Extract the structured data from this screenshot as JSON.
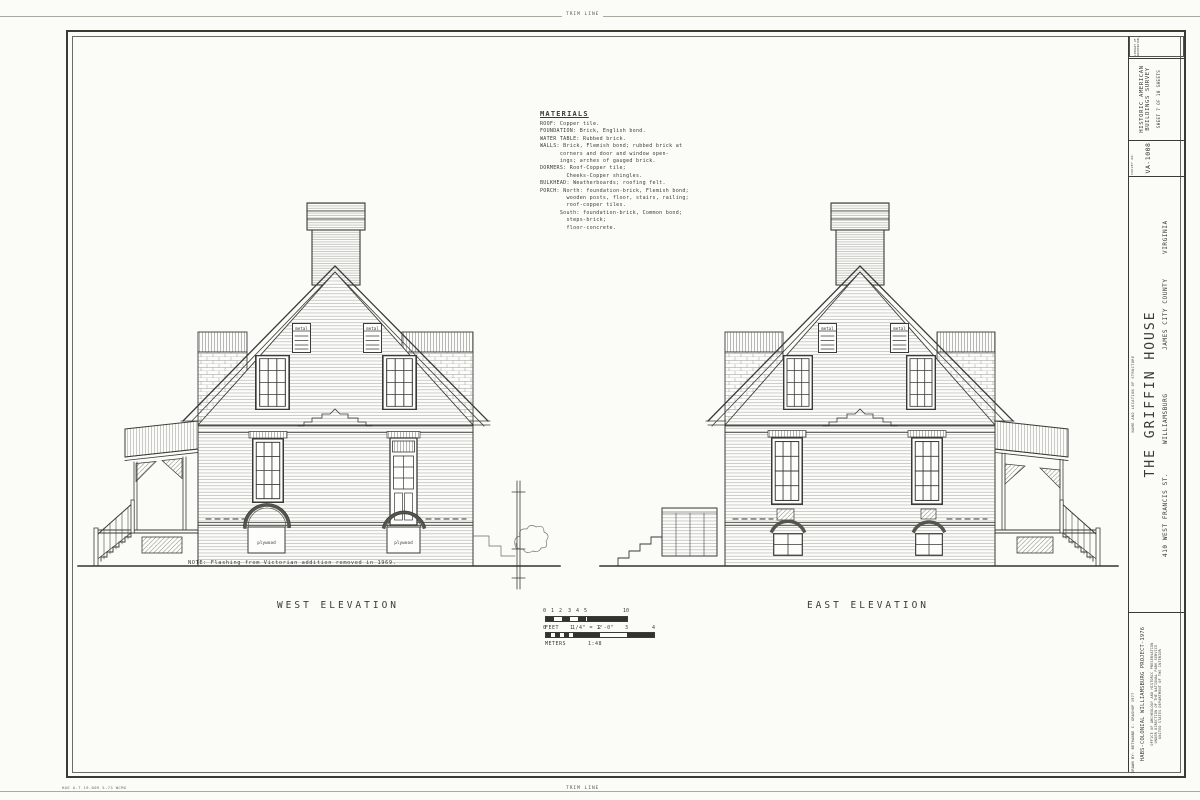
{
  "sheet": {
    "trim_label_top": "TRIM LINE",
    "trim_label_bottom": "TRIM LINE",
    "print_code": "HAE O-T 19-009 5-73 WCMG"
  },
  "materials": {
    "title": "MATERIALS",
    "lines": [
      "ROOF: Copper tile.",
      "FOUNDATION: Brick, English bond.",
      "WATER TABLE: Rubbed brick.",
      "WALLS: Brick, Flemish bond; rubbed brick at",
      "      corners and door and window open-",
      "      ings; arches of gauged brick.",
      "DORMERS: Roof-Copper tile;",
      "        Cheeks-Copper shingles.",
      "BULKHEAD: Weatherboards; roofing felt.",
      "PORCH: North: foundation-brick, Flemish bond;",
      "        wooden posts, floor, stairs, railing;",
      "        roof-copper tiles.",
      "      South: foundation-brick, Common bond;",
      "        steps-brick;",
      "        floor-concrete."
    ]
  },
  "west": {
    "label": "WEST ELEVATION",
    "note": "NOTE: Flashing from Victorian addition removed in 1969.",
    "vent_label": "metal",
    "infill_label": "plywood"
  },
  "east": {
    "label": "EAST ELEVATION",
    "vent_label": "metal"
  },
  "scale": {
    "feet_label": "FEET",
    "feet_ratio": "1/4\" = 1'-0\"",
    "feet_ticks": [
      "0",
      "1",
      "2",
      "3",
      "4",
      "5",
      "10"
    ],
    "meters_label": "METERS",
    "meters_ratio": "1:48",
    "meters_ticks": [
      "0",
      "1",
      "2",
      "3",
      "4"
    ]
  },
  "title_block": {
    "library_line1": "LIBRARY OF CONGRESS",
    "library_line2": "WASHINGTON, D.C.",
    "survey_name_line1": "HISTORIC AMERICAN",
    "survey_name_line2": "BUILDINGS SURVEY",
    "sheet_info": "SHEET 7 OF 10 SHEETS",
    "survey_no_label": "SURVEY NO.",
    "survey_no": "VA-1008",
    "name_caption": "NAME AND LOCATION OF STRUCTURE",
    "structure_name": "THE GRIFFIN HOUSE",
    "address": "410 WEST FRANCIS ST.",
    "city": "WILLIAMSBURG",
    "county": "JAMES CITY COUNTY",
    "state": "VIRGINIA",
    "drawn_by": "DRAWN BY: BETHANNE C. GRASHOF 1977",
    "project": "HABS-COLONIAL WILLIAMSBURG PROJECT-1976",
    "office_line1": "OFFICE OF ARCHEOLOGY AND HISTORIC PRESERVATION",
    "office_line2": "UNDER DIRECTION OF THE NATIONAL PARK SERVICE",
    "office_line3": "UNITED STATES DEPARTMENT OF THE INTERIOR"
  },
  "colors": {
    "paper": "#fbfbf8",
    "ink": "#3a3a36"
  }
}
